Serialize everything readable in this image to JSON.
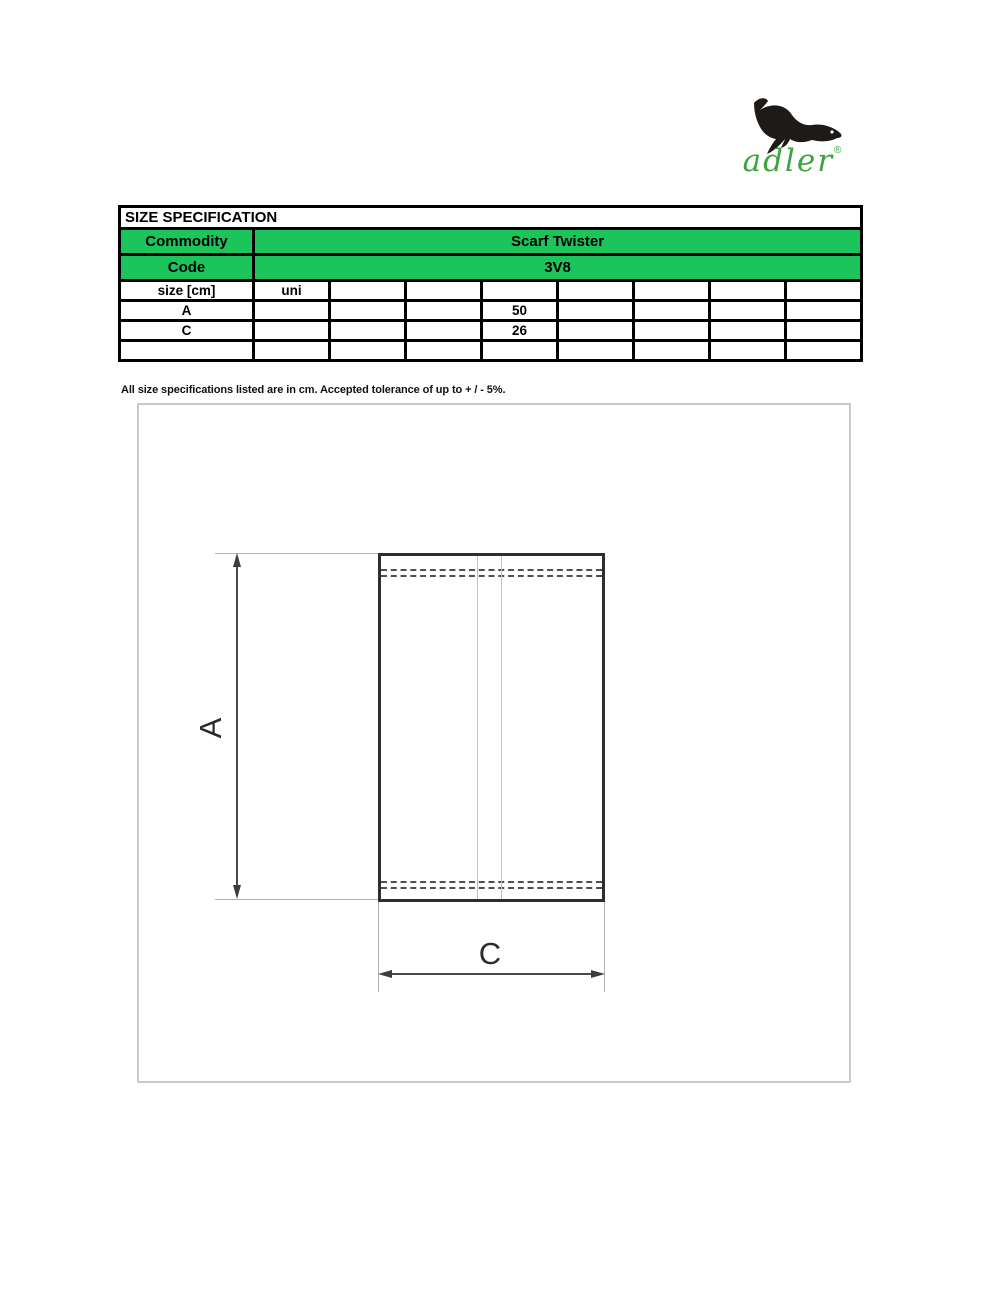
{
  "logo": {
    "brand": "adler",
    "registered": "®"
  },
  "table": {
    "title": "SIZE SPECIFICATION",
    "commodity_label": "Commodity",
    "commodity_value": "Scarf Twister",
    "code_label": "Code",
    "code_value": "3V8",
    "grid": {
      "header": [
        "size [cm]",
        "uni",
        "",
        "",
        "",
        "",
        "",
        "",
        ""
      ],
      "rows": [
        [
          "A",
          "",
          "",
          "",
          "50",
          "",
          "",
          "",
          ""
        ],
        [
          "C",
          "",
          "",
          "",
          "26",
          "",
          "",
          "",
          ""
        ],
        [
          "",
          "",
          "",
          "",
          "",
          "",
          "",
          "",
          ""
        ]
      ]
    }
  },
  "footnote": "All size specifications listed are in cm. Accepted tolerance of up to + / - 5%.",
  "diagram": {
    "dim_a_label": "A",
    "dim_c_label": "C"
  },
  "colors": {
    "accent_green": "#1bc55b",
    "logo_green": "#3ba53b"
  }
}
